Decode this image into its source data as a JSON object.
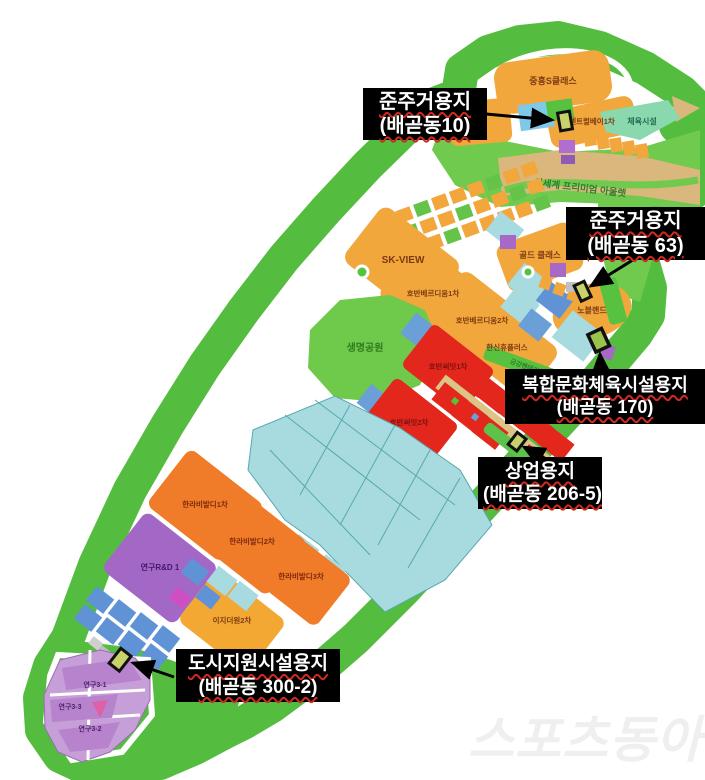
{
  "callouts": [
    {
      "title": "준주거용지",
      "lot": "(배곧동10)"
    },
    {
      "title": "준주거용지",
      "lot": "(배곧동 63)"
    },
    {
      "title": "복합문화체육시설용지",
      "lot": "(배곧동 170)"
    },
    {
      "title": "상업용지",
      "lot": "(배곧동 206-5)"
    },
    {
      "title": "도시지원시설용지",
      "lot": "(배곧동 300-2)"
    }
  ],
  "map": {
    "labels": {
      "jungheung": "중흥S클래스",
      "centum": "센트럴베이1차",
      "sports_facility": "체육시설",
      "outlet": "신세계 프리미엄 아울렛",
      "skview": "SK-VIEW",
      "gold_class": "골드 클래스",
      "hoban1": "호반베르디움1차",
      "hoban2": "호반베르디움2차",
      "hanshin": "한신휴플러스",
      "nobleland": "노블랜드",
      "geumgang": "금강펜테리움1차",
      "park": "생명공원",
      "summit1": "호반써밋1차",
      "summit2": "호반써밋2차",
      "halla1": "한라비발디1차",
      "halla2": "한라비발디2차",
      "halla3": "한라비발디3차",
      "rnd1": "연구R&D 1",
      "ezden2": "이지더원2차",
      "lab31": "연구3-1",
      "lab33": "연구3-3",
      "lab32": "연구3-2"
    }
  },
  "watermark": "스포츠동아",
  "colors": {
    "green": "#54bd3f",
    "light_green": "#6fca4e",
    "orange": "#f2a73d",
    "red": "#e3271c",
    "cyan": "#a7dbe0",
    "blue": "#5f93d6",
    "purple": "#a66fc8",
    "light_purple": "#c79fd8",
    "tan": "#d9b77d",
    "beige": "#dcc386",
    "teal": "#8ad8ae",
    "highlight_parcel": "#c9d16b",
    "pink": "#e060a8",
    "callout_bg": "#000000",
    "callout_text": "#ffffff",
    "squiggle": "#cf2a1f"
  }
}
